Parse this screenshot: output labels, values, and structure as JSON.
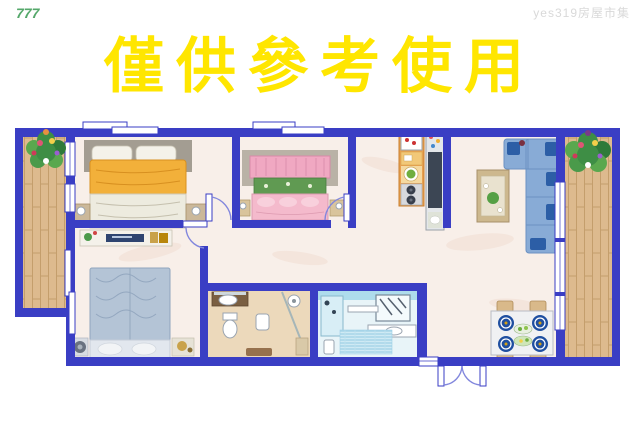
{
  "watermarks": {
    "top_left": "777",
    "top_right": "yes319房屋市集"
  },
  "title": {
    "text": "僅供參考使用"
  },
  "colors": {
    "title_yellow": "#ffe600",
    "watermark_green": "#55a86b",
    "watermark_gray": "#d9d9d9",
    "wall": "#3a3ec4",
    "floor": "#f8efe9",
    "wood": "#ddba8e",
    "wood_line": "#c49e6c",
    "sofa_blue": "#88abd6",
    "pillow_blue": "#2c5ea6",
    "bed1_yellow": "#f2b03a",
    "bed2_pink": "#f0a8c2",
    "bed2_green": "#609a52",
    "bed3_gray": "#b4c4d6",
    "kitchen_orange": "#e8a050",
    "bath2_tile": "#aedcec",
    "plate_blue": "#1f4fa0",
    "table_tan": "#d9b98a"
  }
}
